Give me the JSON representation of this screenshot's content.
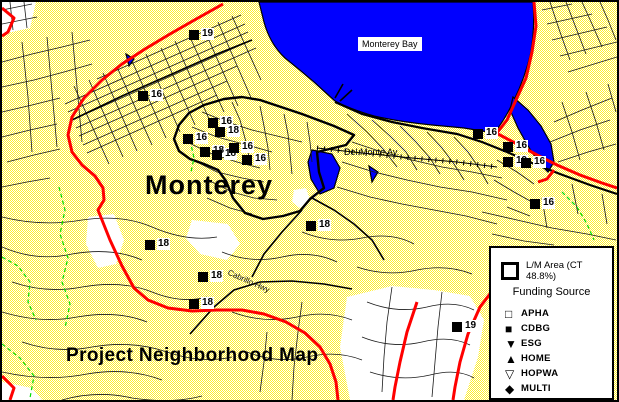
{
  "map": {
    "title": "Project Neighborhood Map",
    "labels": {
      "bay": "Monterey Bay",
      "city": "Monterey",
      "del_monte": "Del Monte Av.",
      "cabrillo": "Cabrillo Hwy"
    },
    "colors": {
      "water": "#0000ff",
      "land_yellow": "#ffff4d",
      "boundary_red": "#ff0000",
      "line_green": "#00dd00",
      "road_black": "#000000",
      "unshaded_white": "#ffffff"
    }
  },
  "markers": [
    {
      "x": 187,
      "y": 28,
      "label": "19"
    },
    {
      "x": 136,
      "y": 89,
      "label": "16"
    },
    {
      "x": 206,
      "y": 116,
      "label": "16"
    },
    {
      "x": 213,
      "y": 125,
      "label": "18"
    },
    {
      "x": 181,
      "y": 132,
      "label": "16"
    },
    {
      "x": 198,
      "y": 145,
      "label": "18"
    },
    {
      "x": 210,
      "y": 148,
      "label": "18"
    },
    {
      "x": 227,
      "y": 141,
      "label": "16"
    },
    {
      "x": 240,
      "y": 153,
      "label": "16"
    },
    {
      "x": 471,
      "y": 127,
      "label": "16"
    },
    {
      "x": 501,
      "y": 140,
      "label": "16"
    },
    {
      "x": 501,
      "y": 155,
      "label": "19"
    },
    {
      "x": 519,
      "y": 156,
      "label": "16"
    },
    {
      "x": 528,
      "y": 197,
      "label": "16"
    },
    {
      "x": 143,
      "y": 238,
      "label": "18"
    },
    {
      "x": 196,
      "y": 270,
      "label": "18"
    },
    {
      "x": 187,
      "y": 297,
      "label": "18"
    },
    {
      "x": 304,
      "y": 219,
      "label": "18"
    },
    {
      "x": 450,
      "y": 320,
      "label": "19"
    }
  ],
  "legend": {
    "lm_label": "L/M Area (CT 48.8%)",
    "funding_title": "Funding Source",
    "items": [
      {
        "icon": "open-square-icon",
        "glyph": "□",
        "label": "APHA"
      },
      {
        "icon": "filled-square-icon",
        "glyph": "■",
        "label": "CDBG"
      },
      {
        "icon": "filled-triangle-down-icon",
        "glyph": "▼",
        "label": "ESG"
      },
      {
        "icon": "filled-triangle-up-icon",
        "glyph": "▲",
        "label": "HOME"
      },
      {
        "icon": "open-triangle-down-icon",
        "glyph": "▽",
        "label": "HOPWA"
      },
      {
        "icon": "filled-diamond-icon",
        "glyph": "◆",
        "label": "MULTI"
      },
      {
        "icon": "open-triangle-up-icon",
        "glyph": "△",
        "label": "PHA"
      }
    ]
  }
}
